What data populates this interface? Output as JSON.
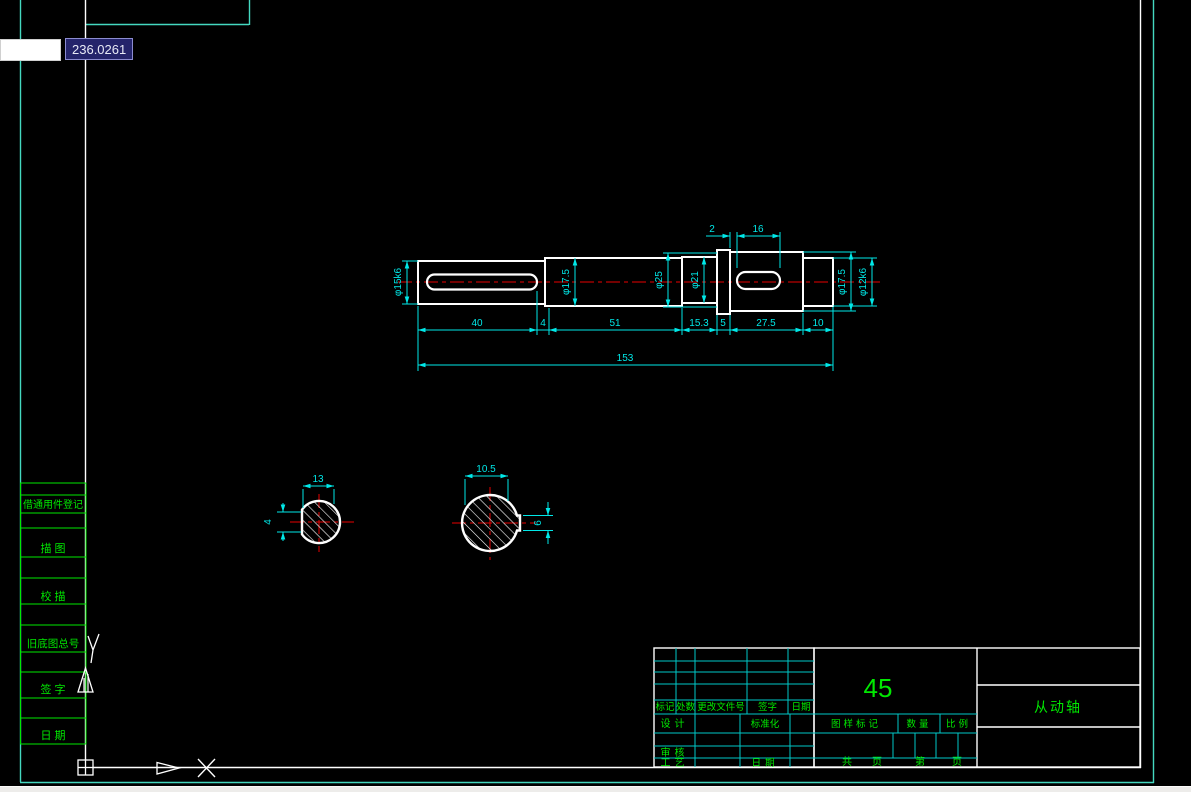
{
  "workspace": {
    "dynamic_input": {
      "value": "",
      "tooltip_value": "236.0261"
    }
  },
  "side_table": {
    "rows": [
      "借通用件登记",
      "描  图",
      "校  描",
      "旧底图总号",
      "签  字",
      "日  期"
    ]
  },
  "shaft_dims": {
    "dia_left_end": "φ15k6",
    "dia_second": "φ17.5",
    "dia_collar": "φ25",
    "dia_third": "φ21",
    "dia_keyseat": "φ17.5",
    "dia_right_end": "φ12k6",
    "key_offset": "2",
    "key_length": "16",
    "len_1": "40",
    "len_2": "4",
    "len_3": "51",
    "len_4": "15.3",
    "len_5": "5",
    "len_6": "27.5",
    "len_7": "10",
    "len_total": "153"
  },
  "section_a": {
    "across": "13",
    "depth": "4"
  },
  "section_b": {
    "across": "10.5",
    "width": "6"
  },
  "title_block": {
    "rev_col_1": "标记",
    "rev_col_2": "处数",
    "rev_col_3": "更改文件号",
    "rev_col_4": "签字",
    "rev_col_5": "日期",
    "row_design": "设计",
    "row_standard": "标准化",
    "row_check": "审核",
    "row_process": "工艺",
    "row_date": "日期",
    "material": "45",
    "mark_label": "图样标记",
    "qty_label": "数量",
    "scale_label": "比例",
    "total_label": "共",
    "sheet_label": "页",
    "no_label": "第",
    "page_label": "页",
    "part_name": "从动轴"
  }
}
